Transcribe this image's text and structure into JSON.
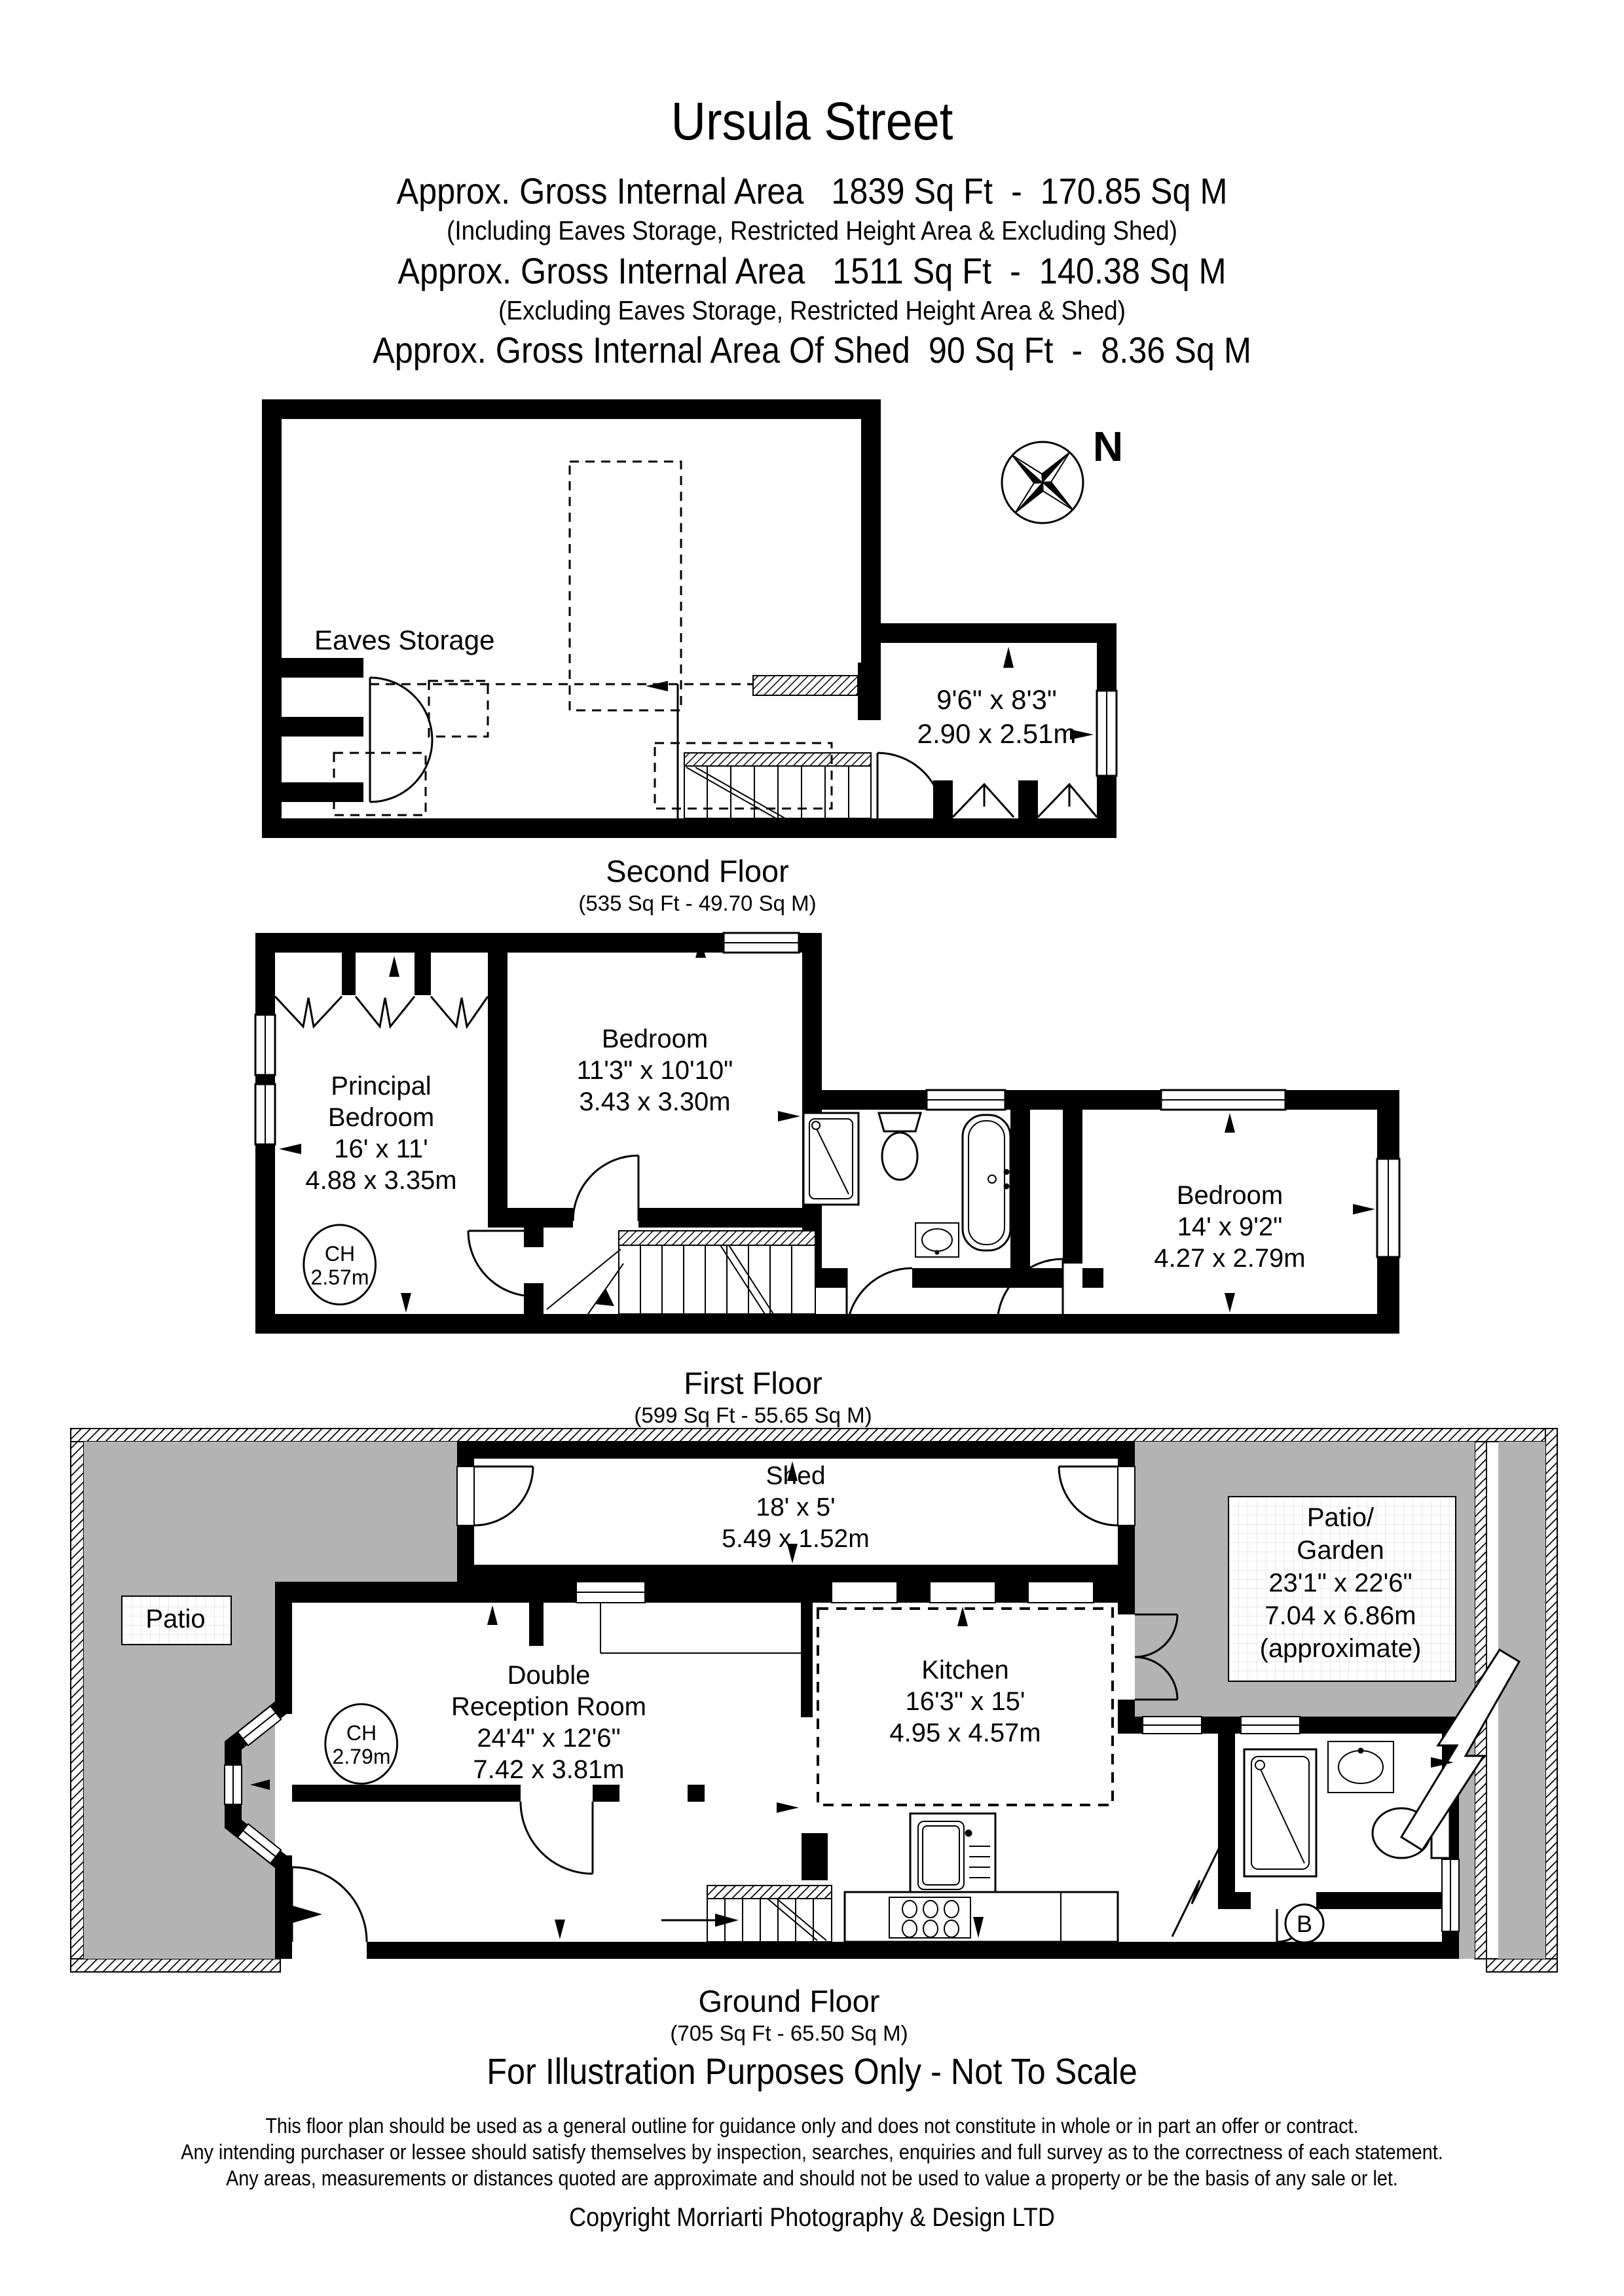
{
  "header": {
    "title": "Ursula Street",
    "area_line1": "Approx. Gross Internal Area   1839 Sq Ft  -  170.85 Sq M",
    "area_note1": "(Including Eaves Storage, Restricted Height Area & Excluding Shed)",
    "area_line2": "Approx. Gross Internal Area   1511 Sq Ft  -  140.38 Sq M",
    "area_note2": "(Excluding Eaves Storage, Restricted Height Area & Shed)",
    "area_line3": "Approx. Gross Internal Area Of Shed  90 Sq Ft  -  8.36 Sq M"
  },
  "compass": {
    "north_label": "N"
  },
  "floors": {
    "second": {
      "name": "Second Floor",
      "area": "(535 Sq Ft - 49.70 Sq M)",
      "eaves_storage": "Eaves Storage",
      "room": {
        "imperial": "9'6\" x 8'3\"",
        "metric": "2.90 x 2.51m"
      }
    },
    "first": {
      "name": "First Floor",
      "area": "(599 Sq Ft - 55.65 Sq M)",
      "principal_bedroom": {
        "l1": "Principal",
        "l2": "Bedroom",
        "imperial": "16' x 11'",
        "metric": "4.88 x 3.35m"
      },
      "bedroom_mid": {
        "name": "Bedroom",
        "imperial": "11'3\" x 10'10\"",
        "metric": "3.43 x 3.30m"
      },
      "bedroom_right": {
        "name": "Bedroom",
        "imperial": "14' x 9'2\"",
        "metric": "4.27 x 2.79m"
      },
      "ceiling_height": {
        "label": "CH",
        "value": "2.57m"
      }
    },
    "ground": {
      "name": "Ground Floor",
      "area": "(705 Sq Ft - 65.50 Sq M)",
      "shed": {
        "name": "Shed",
        "imperial": "18' x 5'",
        "metric": "5.49 x 1.52m"
      },
      "patio": "Patio",
      "patio_garden": {
        "l1": "Patio/",
        "l2": "Garden",
        "imperial": "23'1\" x 22'6\"",
        "metric": "7.04 x 6.86m",
        "note": "(approximate)"
      },
      "reception": {
        "l1": "Double",
        "l2": "Reception Room",
        "imperial": "24'4\" x 12'6\"",
        "metric": "7.42 x 3.81m"
      },
      "kitchen": {
        "name": "Kitchen",
        "imperial": "16'3\" x 15'",
        "metric": "4.95 x 4.57m"
      },
      "ceiling_height": {
        "label": "CH",
        "value": "2.79m"
      },
      "boiler_label": "B"
    }
  },
  "footer": {
    "scale_note": "For Illustration Purposes Only - Not To Scale",
    "disclaimer1": "This floor plan should be used as a general outline for guidance only and does not constitute in whole or in part an offer or contract.",
    "disclaimer2": "Any intending purchaser or lessee should satisfy themselves by inspection, searches, enquiries and full survey as to the correctness of each statement.",
    "disclaimer3": "Any areas, measurements or distances quoted are approximate and should not be used to value a property or be the basis of any sale or let.",
    "copyright": "Copyright Morriarti Photography & Design LTD"
  },
  "colors": {
    "wall": "#000000",
    "patio_gray": "#b3b3b3",
    "background": "#ffffff"
  }
}
